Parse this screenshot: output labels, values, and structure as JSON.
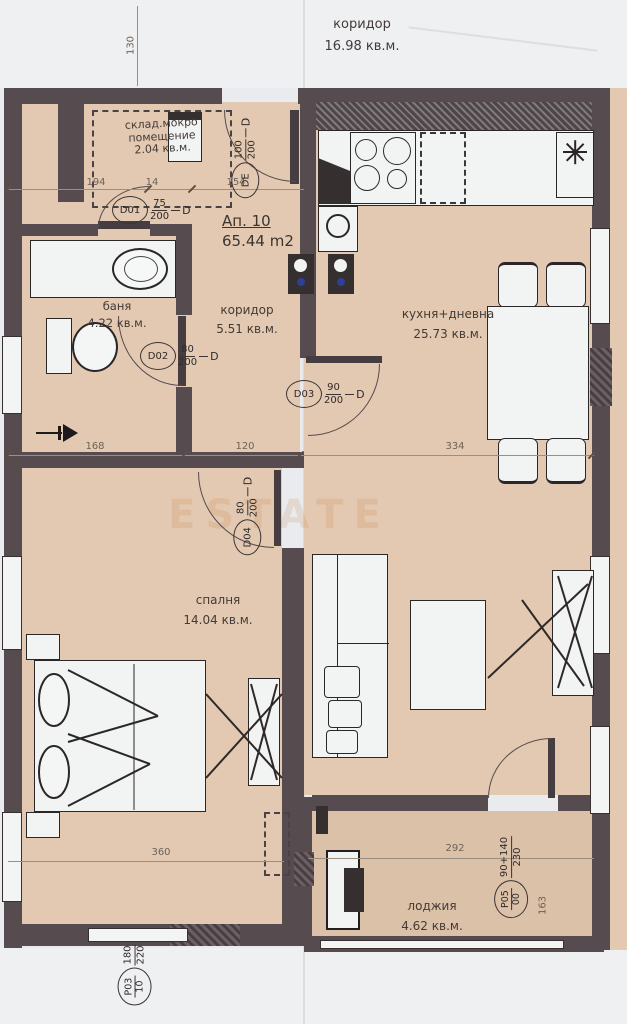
{
  "header": {
    "label": "коридор",
    "area": "16.98 кв.м."
  },
  "apartment": {
    "number": "Ап. 10",
    "area": "65.44 m2"
  },
  "watermark": {
    "text": "ESTATE"
  },
  "rooms": {
    "storage": {
      "name_line1": "склад.мокро",
      "name_line2": "помещение",
      "area": "2.04 кв.м."
    },
    "bath": {
      "name": "баня",
      "area": "4.22 кв.м."
    },
    "hall": {
      "name": "коридор",
      "area": "5.51 кв.м."
    },
    "kitchen": {
      "name": "кухня+дневна",
      "area": "25.73 кв.м."
    },
    "bedroom": {
      "name": "спалня",
      "area": "14.04 кв.м."
    },
    "loggia": {
      "name": "лоджия",
      "area": "4.62 кв.м."
    }
  },
  "doors": {
    "de": {
      "id": "DE",
      "num": "100",
      "den": "200",
      "suffix": "D"
    },
    "d01": {
      "id": "D01",
      "num": "75",
      "den": "200",
      "suffix": "D"
    },
    "d02": {
      "id": "D02",
      "num": "80",
      "den": "200",
      "suffix": "D"
    },
    "d03": {
      "id": "D03",
      "num": "90",
      "den": "200",
      "suffix": "D"
    },
    "d04": {
      "id": "D04",
      "num": "80",
      "den": "200",
      "suffix": "D"
    },
    "p03": {
      "id": "P03",
      "sub": "10",
      "num": "180",
      "den": "220"
    },
    "p05": {
      "id": "P05",
      "sub": "00",
      "num": "90+140",
      "den": "230"
    }
  },
  "dimensions": {
    "left_vertical": "130",
    "top": {
      "d1": "194",
      "d2": "14",
      "d3": "154"
    },
    "middle": {
      "d1": "168",
      "d2": "120",
      "d3": "334"
    },
    "bottom": {
      "bedroom": "360",
      "loggia": "292",
      "right": "163"
    }
  },
  "palette": {
    "floor": "#e3c9b1",
    "wall": "#564c50",
    "paper": "#e9ebee",
    "fixture_white": "#f2f4f3",
    "plumbing_blue": "#2e4094"
  }
}
